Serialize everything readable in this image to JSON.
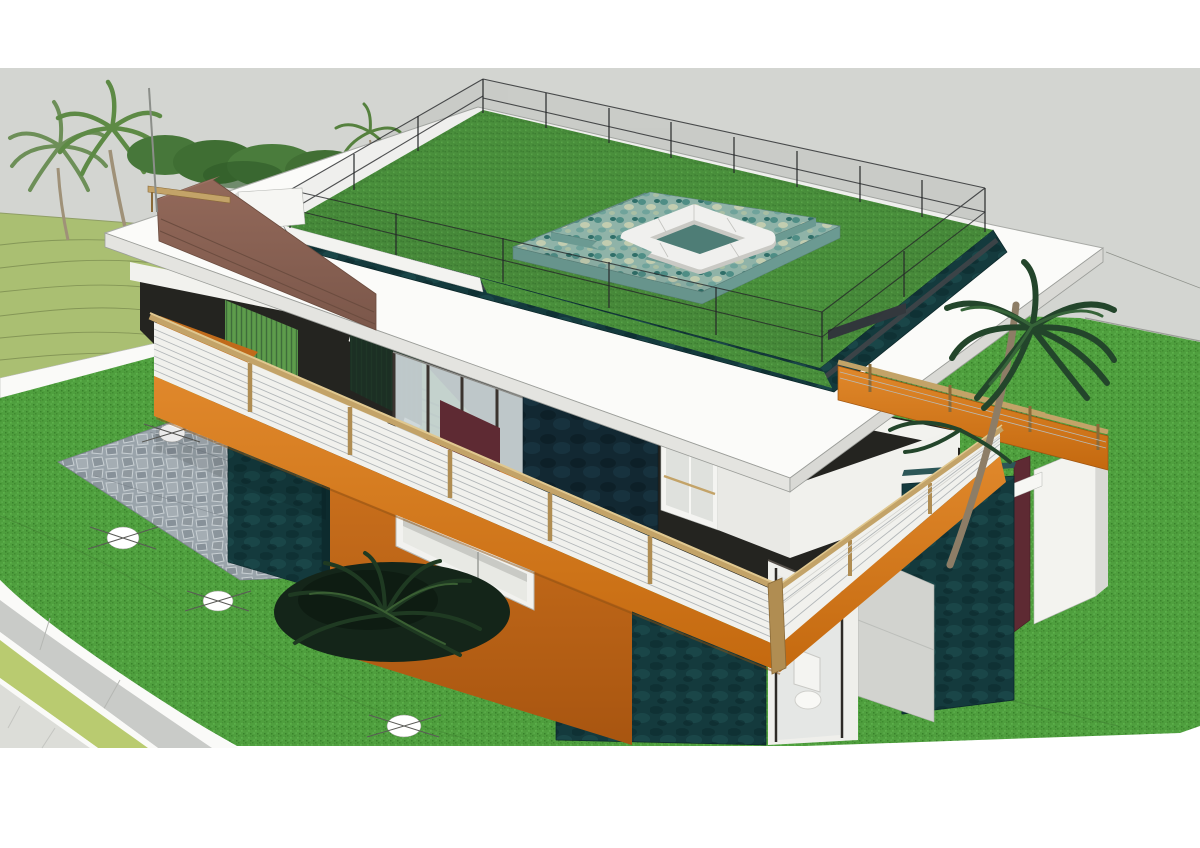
{
  "title": "3D architectural rendering - modern two-story house with rooftop lawn garden, sunken lounge, corten steel balconies and landscaped yard",
  "scene": {
    "style": "SketchUp-like aerial three-quarter view, no visible text",
    "elements": [
      "gray sky band",
      "terraced hillside with contour lines",
      "palm trees and shrubs",
      "rooftop lawn enclosed by wire fence",
      "sunken lounge with white sofas on mosaic stone deck",
      "white flat roof slab",
      "dark teal roof fascia",
      "brown stair parapet wall with wood handrail and thin pole",
      "green louver staircase with white stringer",
      "corten orange balcony parapet with wood rail and white louvers",
      "upper floor glass doors, dark feature wall and white window",
      "lower floor corten wall with ribbon window",
      "dark teal wall panels and maroon edge panel",
      "bathroom with toilet visible through glass",
      "flagstone patio",
      "white survey circle markers",
      "curved driveway with curbs, grass verge and sidewalk",
      "large lawn with faint property lines"
    ]
  },
  "palette": {
    "white": "#ffffff",
    "sky": "#d3d5d1",
    "hillside": "#aabf72",
    "hillside_line": "#7e8f52",
    "lawn": "#4f9f3e",
    "lawn_line": "#3f7a30",
    "roof_grass": "#4a8f3c",
    "slab": "#fbfbf9",
    "slab_edge": "#a9aba7",
    "fascia_teal": "#143a3d",
    "charcoal": "#3d4348",
    "corten": "#d2731f",
    "corten_deep": "#a85510",
    "wood": "#c3a368",
    "wood_dark": "#8a6a38",
    "louver": "#f1f1ed",
    "louver_line": "#a8adb0",
    "brown": "#8a6353",
    "brown_seam": "#6b4c3f",
    "stair_green": "#67a250",
    "stair_line": "#2e5c33",
    "screen_dark": "#1c2f24",
    "mosaic": "#8fb3a8",
    "mosaic_dark": "#6b9a92",
    "sofa": "#f0f0ee",
    "sofa_shadow": "#c9c9c4",
    "glass": "#ccd6d8",
    "mullion": "#3a332e",
    "navy": "#122832",
    "maroon": "#5e2a33",
    "road": "#c9cbc8",
    "curb": "#fafaf8",
    "verge": "#b9cb70",
    "walk": "#dcddd8",
    "stone": "#9aa4ab",
    "stone_line": "#c8cfd3",
    "palm": "#5d8a45",
    "palm_dark": "#23452b",
    "palm_trunk": "#8d7d66",
    "fence": "#26282a",
    "marker_line": "#5a5a56",
    "interior_dark": "#242420",
    "cream_floor": "#ebe8dc"
  }
}
